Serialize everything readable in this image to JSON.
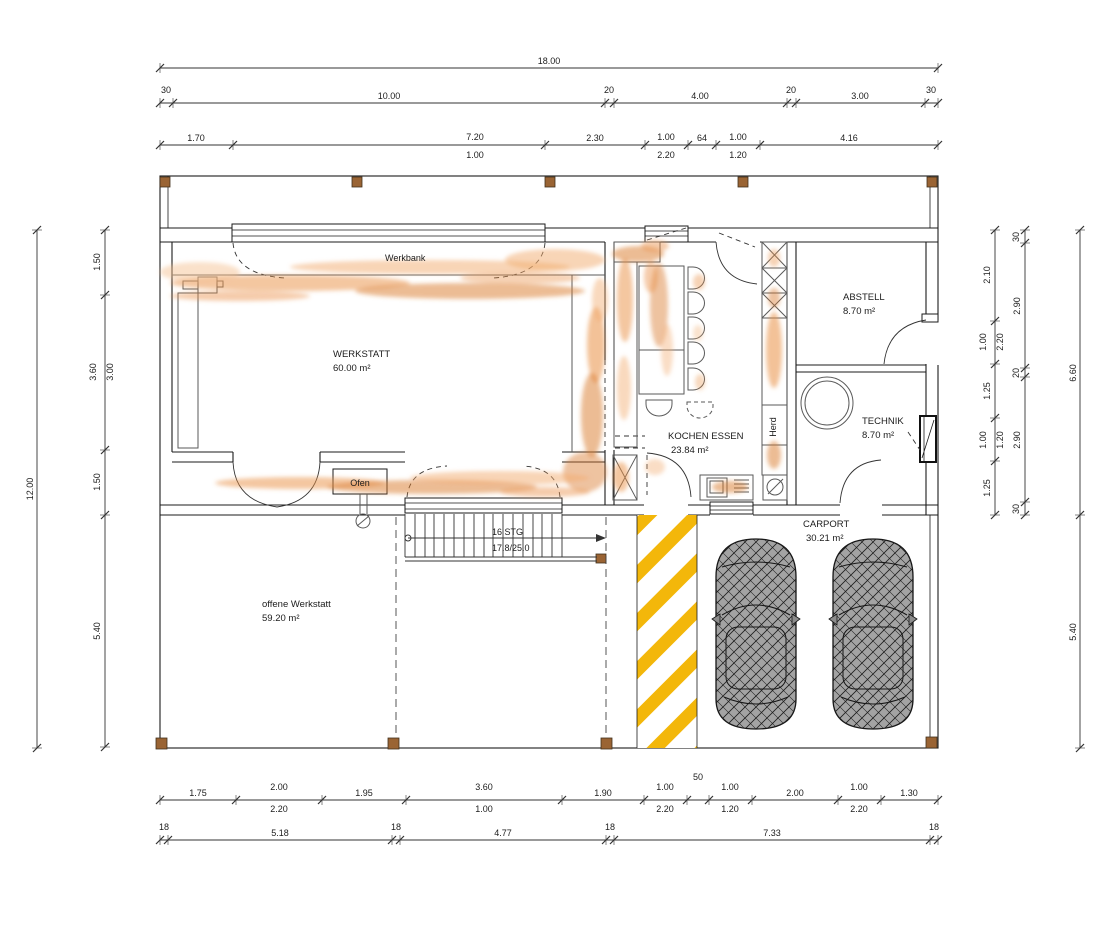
{
  "plan": {
    "rooms": {
      "werkstatt": {
        "name": "WERKSTATT",
        "area": "60.00 m²"
      },
      "kochen_essen": {
        "name": "KOCHEN ESSEN",
        "area": "23.84 m²"
      },
      "abstell": {
        "name": "ABSTELL",
        "area": "8.70 m²"
      },
      "technik": {
        "name": "TECHNIK",
        "area": "8.70 m²"
      },
      "carport": {
        "name": "CARPORT",
        "area": "30.21 m²"
      },
      "offene_werkstatt": {
        "name": "offene Werkstatt",
        "area": "59.20 m²"
      }
    },
    "labels": {
      "werkbank": "Werkbank",
      "ofen": "Ofen",
      "herd": "Herd",
      "stairs_count": "16 STG",
      "stairs_ratio": "17.8/25.0"
    },
    "dimensions": {
      "top_total": "18.00",
      "top_axes": [
        "30",
        "10.00",
        "20",
        "4.00",
        "20",
        "3.00",
        "30"
      ],
      "top_detail": [
        "1.70",
        "7.20",
        "1.00",
        "2.30",
        "1.00",
        "2.20",
        "64",
        "1.00",
        "1.20",
        "4.16"
      ],
      "bottom_detail": [
        "1.75",
        "2.00",
        "2.20",
        "1.95",
        "3.60",
        "1.00",
        "1.90",
        "1.00",
        "2.20",
        "50",
        "1.00",
        "1.20",
        "2.00",
        "1.00",
        "2.20",
        "1.30"
      ],
      "bottom_axes": [
        "18",
        "5.18",
        "18",
        "4.77",
        "18",
        "7.33",
        "18"
      ],
      "left_total": "12.00",
      "left_detail": [
        "1.50",
        "3.60",
        "3.00",
        "1.50",
        "5.40"
      ],
      "right_detail": [
        "2.10",
        "1.00",
        "2.20",
        "1.25",
        "1.00",
        "1.20",
        "1.25"
      ],
      "right_axes": [
        "30",
        "2.90",
        "20",
        "2.90",
        "30"
      ],
      "right_totals": [
        "6.60",
        "5.40"
      ]
    },
    "colors": {
      "highlight_orange": "#e98f44",
      "stripe_yellow": "#f3b70a",
      "post_brown": "#9a6434",
      "car_gray": "#a3a3a3"
    }
  }
}
